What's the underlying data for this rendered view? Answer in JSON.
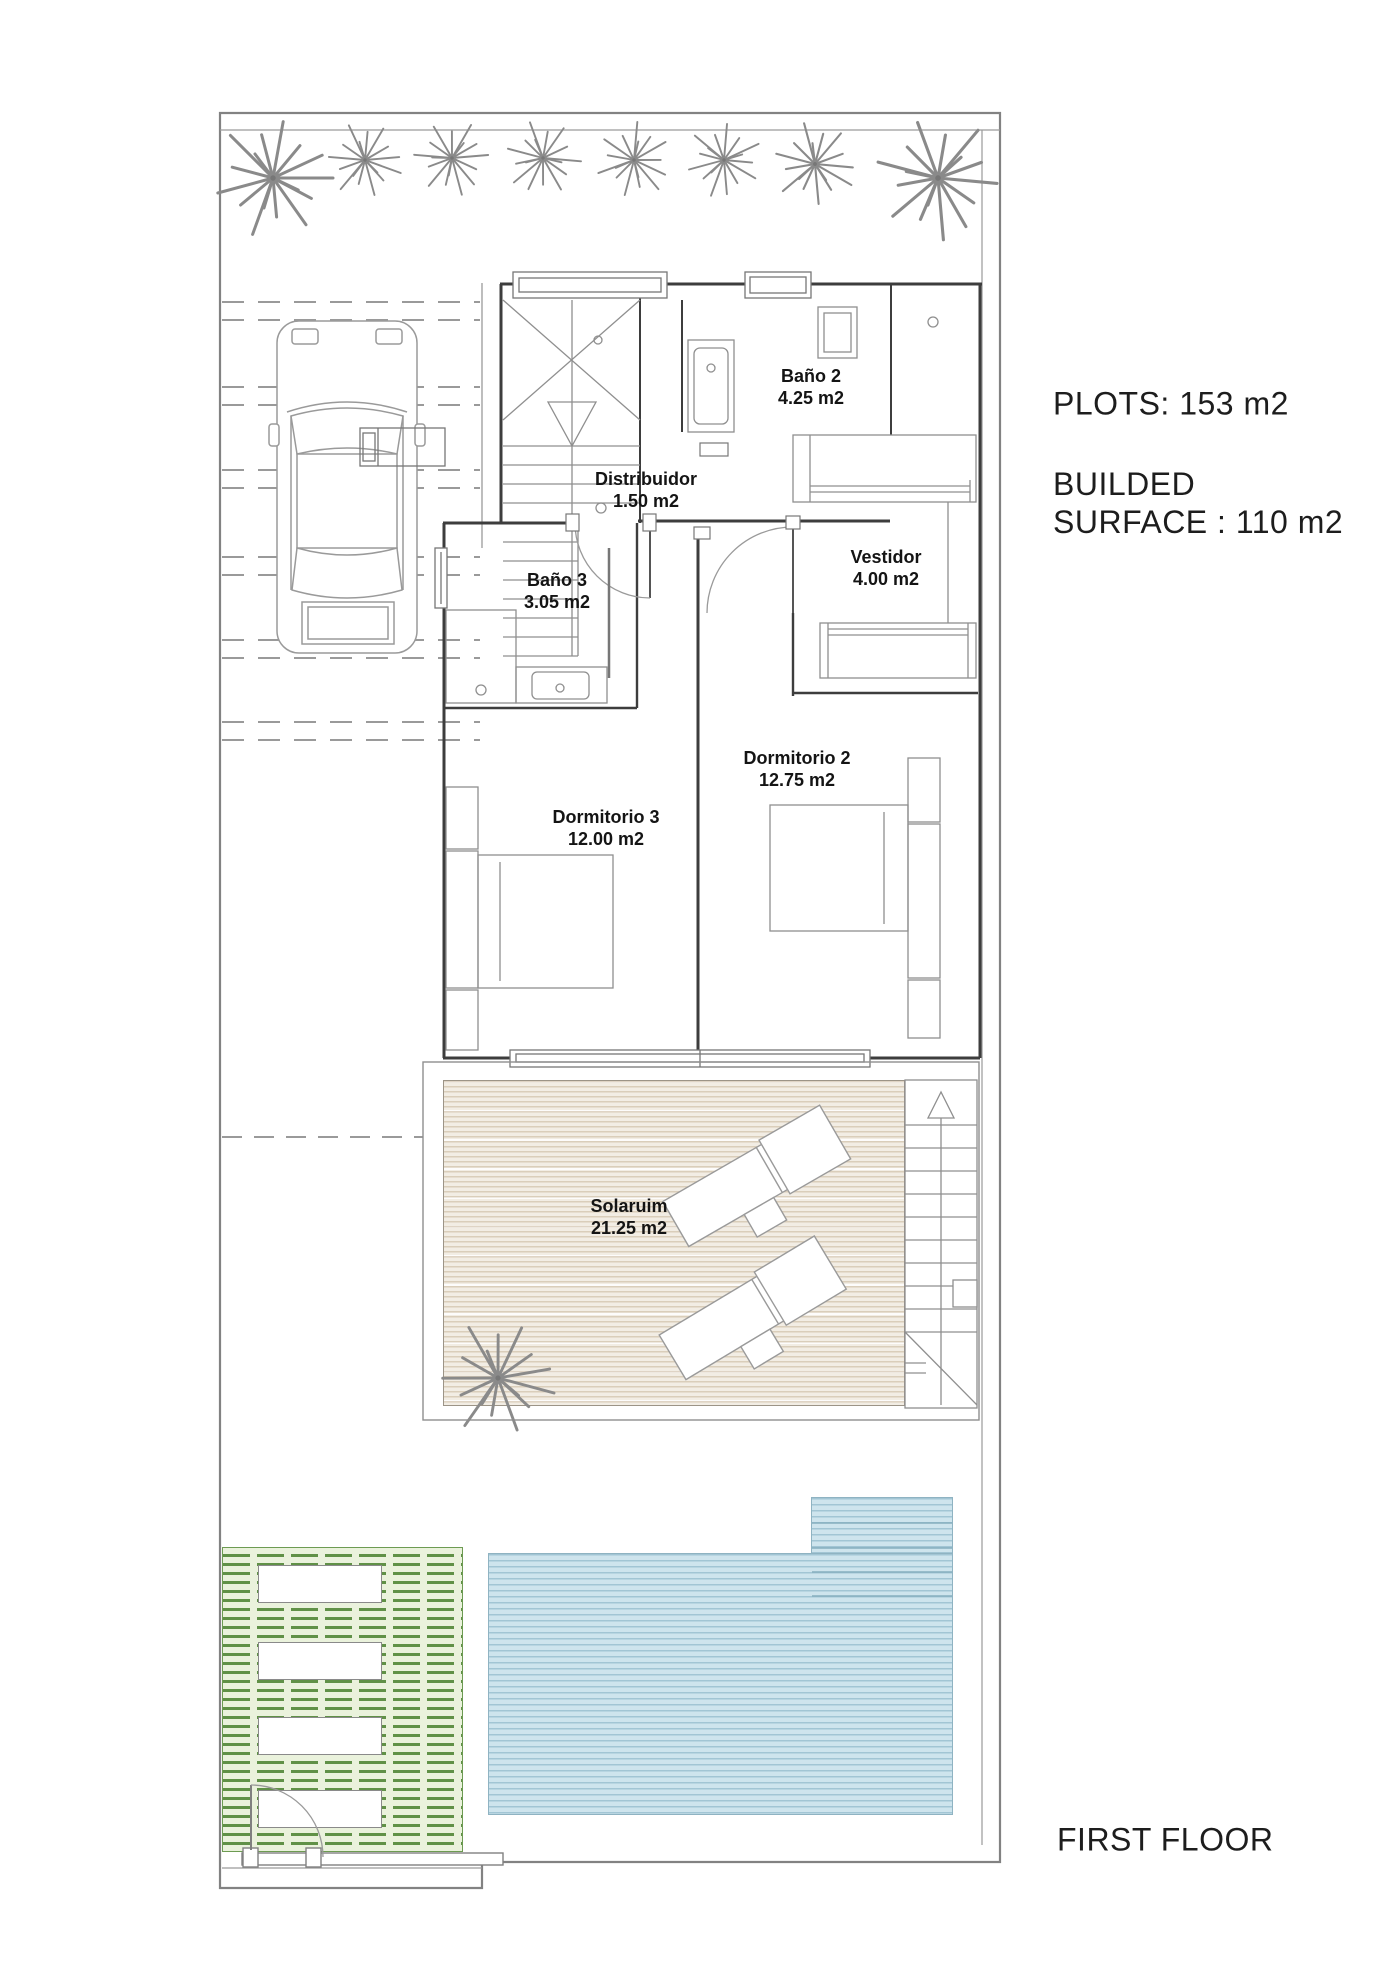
{
  "title": "First floor architectural plan",
  "annotations": {
    "plots": "PLOTS: 153 m2",
    "builded_line1": "BUILDED",
    "builded_line2": "SURFACE : 110 m2",
    "floor_label": "FIRST FLOOR"
  },
  "rooms": [
    {
      "name": "Baño 2",
      "area": "4.25 m2"
    },
    {
      "name": "Distribuidor",
      "area": "1.50 m2"
    },
    {
      "name": "Vestidor",
      "area": "4.00 m2"
    },
    {
      "name": "Baño 3",
      "area": "3.05 m2"
    },
    {
      "name": "Dormitorio 2",
      "area": "12.75 m2"
    },
    {
      "name": "Dormitorio 3",
      "area": "12.00 m2"
    },
    {
      "name": "Solaruim",
      "area": "21.25 m2"
    }
  ],
  "colors": {
    "paper": "#ffffff",
    "line": "#6f6f6f",
    "wall": "#3d3d3d",
    "furniture": "#8f8f8f",
    "pool_fill": "#cee4ed",
    "pool_line": "#8fb3c2",
    "grass_fill": "#eaf2dc",
    "grass_line": "#609147",
    "deck_fill": "#f2ede4",
    "deck_line": "#c6b498"
  }
}
